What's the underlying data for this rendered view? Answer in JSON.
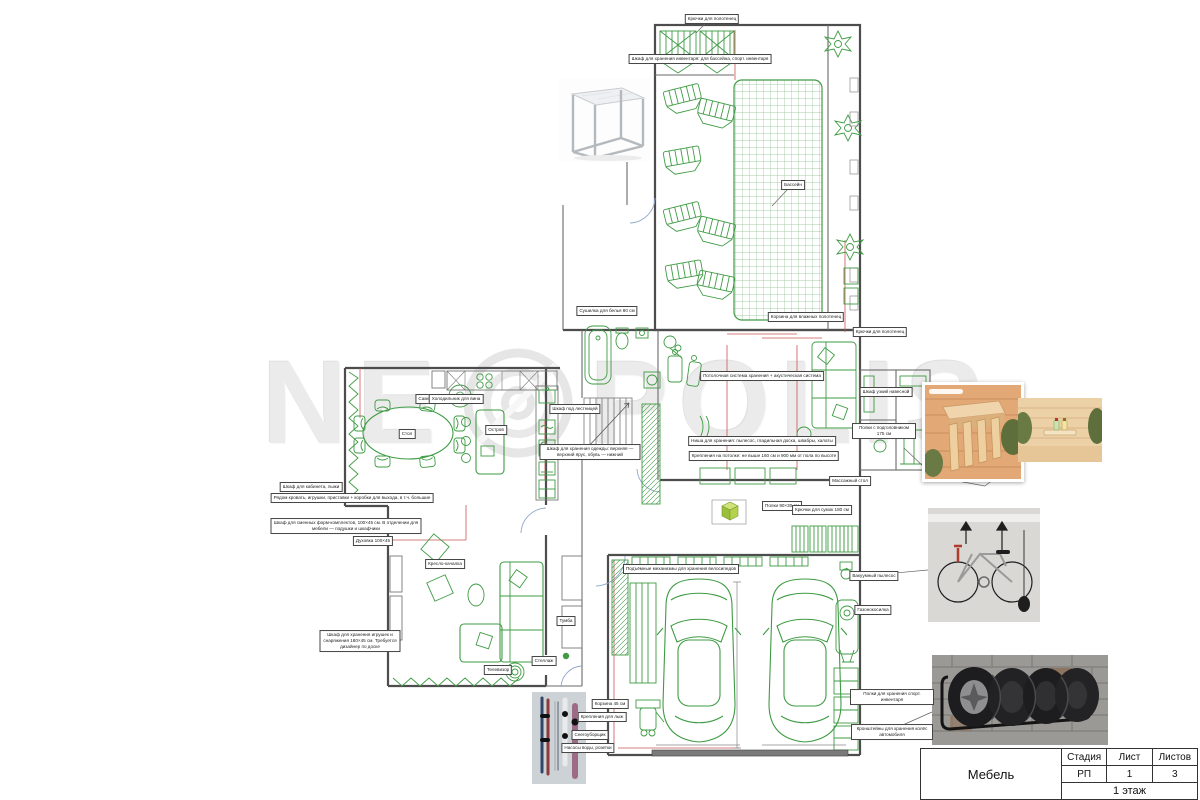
{
  "watermark": {
    "left": "NE",
    "right": "POLIS"
  },
  "title_block": {
    "name": "Мебель",
    "stage_label": "Стадия",
    "sheet_label": "Лист",
    "sheets_label": "Листов",
    "stage": "РП",
    "sheet": "1",
    "sheets": "3",
    "floor": "1 этаж"
  },
  "colors": {
    "furniture_green": "#3f9b44",
    "grid_green": "#8cc08c",
    "wall_gray": "#4d4d4d",
    "dimension_red": "#cc5555",
    "door_arc_blue": "#8fa8c8",
    "lime_accent": "#a6ce39",
    "brick_gray": "#9b9995",
    "wood_tan": "#e0b285"
  },
  "figures": [
    {
      "name": "metal-frame-side-table-photo"
    },
    {
      "name": "sauna-headrest-photo"
    },
    {
      "name": "sauna-shelf-aroma-oils-photo"
    },
    {
      "name": "bicycle-ceiling-hoist-photo"
    },
    {
      "name": "tire-wall-rack-photo"
    },
    {
      "name": "ski-snowboard-wall-rack-photo"
    }
  ],
  "callouts": [
    {
      "x": 712,
      "y": 19,
      "label": "Крючки для полотенец"
    },
    {
      "x": 700,
      "y": 59,
      "label": "Шкаф для хранения инвентаря: для бассейна, спорт. инвентаря",
      "w": 190
    },
    {
      "x": 793,
      "y": 185,
      "label": "Бассейн"
    },
    {
      "x": 607,
      "y": 311,
      "label": "Сушилка для белья 80 см"
    },
    {
      "x": 806,
      "y": 317,
      "label": "Корзина для влажных полотенец"
    },
    {
      "x": 880,
      "y": 332,
      "label": "Крючки для полотенец"
    },
    {
      "x": 886,
      "y": 392,
      "label": "Шкаф узкий навесной",
      "w": 60
    },
    {
      "x": 884,
      "y": 431,
      "label": "Полки с подголовником 175 см",
      "w": 58
    },
    {
      "x": 762,
      "y": 376,
      "label": "Потолочная система хранения + акустическая система",
      "w": 150
    },
    {
      "x": 762,
      "y": 441,
      "label": "Ниша для хранения: пылесос, гладильная доска, швабры, халаты",
      "w": 200
    },
    {
      "x": 764,
      "y": 456,
      "label": "Крепления на потолке: не выше 160 см и 900 мм от пола по высоте",
      "w": 210
    },
    {
      "x": 311,
      "y": 487,
      "label": "Шкаф для кабинета, лыжи"
    },
    {
      "x": 352,
      "y": 498,
      "label": "Рядом кровать, игрушки, приставки + коробки для выхода, в т.ч. большие",
      "w": 230
    },
    {
      "x": 346,
      "y": 526,
      "label": "Шкаф для сменных форм-комплектов, 100×45 см. В отделении для мебели — подушки и шкафчики",
      "w": 145
    },
    {
      "x": 373,
      "y": 541,
      "label": "Духовка 100×45"
    },
    {
      "x": 445,
      "y": 564,
      "label": "Кресло-качалка"
    },
    {
      "x": 407,
      "y": 434,
      "label": "Стол"
    },
    {
      "x": 428,
      "y": 399,
      "label": "Самовар"
    },
    {
      "x": 496,
      "y": 430,
      "label": "Остров"
    },
    {
      "x": 456,
      "y": 399,
      "label": "Холодильник для вина"
    },
    {
      "x": 544,
      "y": 661,
      "label": "Стеллаж"
    },
    {
      "x": 566,
      "y": 621,
      "label": "Тумба"
    },
    {
      "x": 498,
      "y": 670,
      "label": "Телевизор"
    },
    {
      "x": 681,
      "y": 569,
      "label": "Подъёмные механизмы для хранения велосипедов",
      "w": 170
    },
    {
      "x": 874,
      "y": 576,
      "label": "Вакуумный пылесос"
    },
    {
      "x": 873,
      "y": 610,
      "label": "Газонокосилка"
    },
    {
      "x": 892,
      "y": 697,
      "label": "Полки для хранения спорт. инвентаря",
      "w": 78
    },
    {
      "x": 892,
      "y": 732,
      "label": "Кронштейны для хранения колёс автомобиля",
      "w": 76
    },
    {
      "x": 610,
      "y": 704,
      "label": "Корзина 45 см"
    },
    {
      "x": 602,
      "y": 717,
      "label": "Крепления для лыж"
    },
    {
      "x": 590,
      "y": 735,
      "label": "Снегоуборщик"
    },
    {
      "x": 588,
      "y": 748,
      "label": "Насосы воды, розетки"
    },
    {
      "x": 575,
      "y": 409,
      "label": "Шкаф под лестницей"
    },
    {
      "x": 850,
      "y": 481,
      "label": "Массажный стол"
    },
    {
      "x": 782,
      "y": 506,
      "label": "Полки 90×30 см"
    },
    {
      "x": 822,
      "y": 510,
      "label": "Крючки для сумок 180 см"
    },
    {
      "x": 360,
      "y": 641,
      "label": "Шкаф для хранения игрушек и снаряжения 180×45 см. Требуется дизайнер по доске",
      "w": 75
    },
    {
      "x": 590,
      "y": 452,
      "label": "Шкаф для хранения одежды: верхняя — верхний ярус, обувь — нижний",
      "w": 95
    }
  ]
}
